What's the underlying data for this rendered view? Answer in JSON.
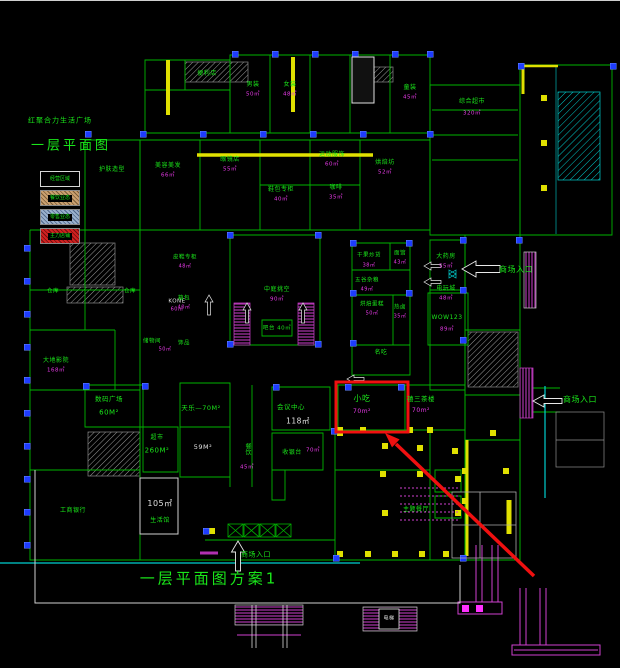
{
  "header": {
    "project_title": "红聚合力生活广场",
    "drawing_title": "一层平面图"
  },
  "footer": {
    "scheme_title": "一层平面图方案1"
  },
  "legend": {
    "items": [
      {
        "label": "经营区域",
        "swatch": "dark"
      },
      {
        "label": "餐饮业态",
        "swatch": "tan-hatch"
      },
      {
        "label": "零售业态",
        "swatch": "blue-hatch"
      },
      {
        "label": "主力店铺",
        "swatch": "red-hatch"
      }
    ]
  },
  "highlight": {
    "shop_name": "小吃",
    "shop_area": "70m²",
    "marker": "red-rectangle-with-arrow"
  },
  "colors": {
    "background": "#000000",
    "wall_green": "#00b400",
    "grid_cyan": "#00d0d0",
    "accent_yellow": "#e0e000",
    "detail_magenta": "#d040d0",
    "column_blue": "#1e3cff",
    "highlight_red": "#f01010",
    "text_green": "#1ae61a",
    "area_magenta": "#e83ae8",
    "text_white": "#e0e0e0"
  },
  "labels": [
    {
      "n": "entrance-label",
      "t": "商场入口",
      "x": 516,
      "y": 270,
      "s": 8,
      "c": "g"
    },
    {
      "n": "entrance-label",
      "t": "商场入口",
      "x": 580,
      "y": 400,
      "s": 8,
      "c": "g"
    },
    {
      "n": "entrance-label",
      "t": "商场入口",
      "x": 256,
      "y": 555,
      "s": 7,
      "c": "g"
    },
    {
      "n": "highlight-shop-name",
      "t": "小吃",
      "x": 362,
      "y": 399,
      "s": 8,
      "c": "g"
    },
    {
      "n": "highlight-shop-area",
      "t": "70m²",
      "x": 362,
      "y": 412,
      "s": 6,
      "c": "m"
    },
    {
      "n": "room-name",
      "t": "禧三茶楼",
      "x": 421,
      "y": 399,
      "s": 6.5,
      "c": "g"
    },
    {
      "n": "room-area",
      "t": "70m²",
      "x": 421,
      "y": 411,
      "s": 6,
      "c": "m"
    },
    {
      "n": "room-name",
      "t": "天乐—70M²",
      "x": 201,
      "y": 408,
      "s": 6.5,
      "c": "g"
    },
    {
      "n": "room-area",
      "t": "59M²",
      "x": 203,
      "y": 447,
      "s": 6.5,
      "c": "w"
    },
    {
      "n": "room-name",
      "t": "餐饮",
      "x": 247,
      "y": 449,
      "s": 6,
      "c": "g",
      "v": 1
    },
    {
      "n": "room-area",
      "t": "45㎡",
      "x": 247,
      "y": 468,
      "s": 5.5,
      "c": "m"
    },
    {
      "n": "room-name",
      "t": "会议中心",
      "x": 291,
      "y": 407,
      "s": 6.5,
      "c": "g"
    },
    {
      "n": "room-area",
      "t": "118㎡",
      "x": 298,
      "y": 421,
      "s": 7.5,
      "c": "w"
    },
    {
      "n": "room-name",
      "t": "收银台",
      "x": 292,
      "y": 453,
      "s": 6,
      "c": "g"
    },
    {
      "n": "room-area",
      "t": "70㎡",
      "x": 313,
      "y": 451,
      "s": 5.5,
      "c": "m"
    },
    {
      "n": "room-name",
      "t": "数码广场",
      "x": 109,
      "y": 399,
      "s": 6.5,
      "c": "g"
    },
    {
      "n": "room-area",
      "t": "60M²",
      "x": 109,
      "y": 413,
      "s": 7,
      "c": "g"
    },
    {
      "n": "room-name",
      "t": "超市",
      "x": 157,
      "y": 438,
      "s": 6,
      "c": "g"
    },
    {
      "n": "room-area",
      "t": "260M²",
      "x": 157,
      "y": 451,
      "s": 7,
      "c": "g"
    },
    {
      "n": "room-area",
      "t": "105㎡",
      "x": 160,
      "y": 504,
      "s": 8,
      "c": "w"
    },
    {
      "n": "room-name",
      "t": "生活馆",
      "x": 160,
      "y": 521,
      "s": 6,
      "c": "g"
    },
    {
      "n": "room-name",
      "t": "工商银行",
      "x": 73,
      "y": 511,
      "s": 6,
      "c": "g"
    },
    {
      "n": "elevator-label",
      "t": "KONE",
      "x": 177,
      "y": 302,
      "s": 5.5,
      "c": "w"
    },
    {
      "n": "room-area",
      "t": "60㎡",
      "x": 177,
      "y": 310,
      "s": 5,
      "c": "m"
    },
    {
      "n": "room-name",
      "t": "大地影院",
      "x": 56,
      "y": 361,
      "s": 6,
      "c": "g"
    },
    {
      "n": "room-area",
      "t": "168㎡",
      "x": 56,
      "y": 371,
      "s": 5.5,
      "c": "m"
    },
    {
      "n": "room-name",
      "t": "仓库",
      "x": 53,
      "y": 292,
      "s": 5.5,
      "c": "g"
    },
    {
      "n": "room-name",
      "t": "仓库",
      "x": 130,
      "y": 292,
      "s": 5.5,
      "c": "g"
    },
    {
      "n": "room-name",
      "t": "储物间",
      "x": 152,
      "y": 342,
      "s": 5.5,
      "c": "g"
    },
    {
      "n": "room-area",
      "t": "50㎡",
      "x": 165,
      "y": 350,
      "s": 5,
      "c": "m"
    },
    {
      "n": "room-name",
      "t": "男装",
      "x": 253,
      "y": 85,
      "s": 6,
      "c": "g"
    },
    {
      "n": "room-area",
      "t": "50㎡",
      "x": 253,
      "y": 95,
      "s": 5.5,
      "c": "m"
    },
    {
      "n": "room-name",
      "t": "女装",
      "x": 290,
      "y": 85,
      "s": 6,
      "c": "g"
    },
    {
      "n": "room-area",
      "t": "48㎡",
      "x": 290,
      "y": 95,
      "s": 5.5,
      "c": "m"
    },
    {
      "n": "room-name",
      "t": "童装",
      "x": 410,
      "y": 88,
      "s": 6,
      "c": "g"
    },
    {
      "n": "room-area",
      "t": "45㎡",
      "x": 410,
      "y": 98,
      "s": 5.5,
      "c": "m"
    },
    {
      "n": "room-name",
      "t": "便利店",
      "x": 207,
      "y": 74,
      "s": 6,
      "c": "g"
    },
    {
      "n": "room-name",
      "t": "综合超市",
      "x": 472,
      "y": 102,
      "s": 6,
      "c": "g"
    },
    {
      "n": "room-area",
      "t": "320㎡",
      "x": 472,
      "y": 114,
      "s": 5.5,
      "c": "m"
    },
    {
      "n": "room-name",
      "t": "护肤造型",
      "x": 112,
      "y": 170,
      "s": 6,
      "c": "g"
    },
    {
      "n": "room-name",
      "t": "美容美发",
      "x": 168,
      "y": 166,
      "s": 6,
      "c": "g"
    },
    {
      "n": "room-area",
      "t": "66㎡",
      "x": 168,
      "y": 176,
      "s": 5.5,
      "c": "m"
    },
    {
      "n": "room-name",
      "t": "眼镜店",
      "x": 230,
      "y": 160,
      "s": 6,
      "c": "g"
    },
    {
      "n": "room-area",
      "t": "55㎡",
      "x": 230,
      "y": 170,
      "s": 5.5,
      "c": "m"
    },
    {
      "n": "room-name",
      "t": "鞋包专柜",
      "x": 281,
      "y": 190,
      "s": 6,
      "c": "g"
    },
    {
      "n": "room-area",
      "t": "40㎡",
      "x": 281,
      "y": 200,
      "s": 5.5,
      "c": "m"
    },
    {
      "n": "room-name",
      "t": "运动服饰",
      "x": 332,
      "y": 155,
      "s": 6,
      "c": "g"
    },
    {
      "n": "room-area",
      "t": "60㎡",
      "x": 332,
      "y": 165,
      "s": 5.5,
      "c": "m"
    },
    {
      "n": "room-name",
      "t": "咖啡",
      "x": 336,
      "y": 188,
      "s": 6,
      "c": "g"
    },
    {
      "n": "room-area",
      "t": "35㎡",
      "x": 336,
      "y": 198,
      "s": 5.5,
      "c": "m"
    },
    {
      "n": "room-name",
      "t": "烘焙坊",
      "x": 385,
      "y": 163,
      "s": 6,
      "c": "g"
    },
    {
      "n": "room-area",
      "t": "52㎡",
      "x": 385,
      "y": 173,
      "s": 5.5,
      "c": "m"
    },
    {
      "n": "room-name",
      "t": "皮鞋专柜",
      "x": 185,
      "y": 258,
      "s": 5.5,
      "c": "g"
    },
    {
      "n": "room-area",
      "t": "48㎡",
      "x": 185,
      "y": 267,
      "s": 5,
      "c": "m"
    },
    {
      "n": "room-name",
      "t": "箱包",
      "x": 184,
      "y": 299,
      "s": 5.5,
      "c": "g"
    },
    {
      "n": "room-area",
      "t": "40㎡",
      "x": 184,
      "y": 308,
      "s": 5,
      "c": "m"
    },
    {
      "n": "room-name",
      "t": "饰品",
      "x": 184,
      "y": 344,
      "s": 5.5,
      "c": "g"
    },
    {
      "n": "room-name",
      "t": "大药房",
      "x": 446,
      "y": 257,
      "s": 6,
      "c": "g"
    },
    {
      "n": "room-area",
      "t": "55㎡",
      "x": 446,
      "y": 267,
      "s": 5.5,
      "c": "m"
    },
    {
      "n": "room-name",
      "t": "电玩城",
      "x": 446,
      "y": 289,
      "s": 6,
      "c": "g"
    },
    {
      "n": "room-area",
      "t": "48㎡",
      "x": 446,
      "y": 299,
      "s": 5.5,
      "c": "m"
    },
    {
      "n": "atrium-label",
      "t": "中庭挑空",
      "x": 277,
      "y": 290,
      "s": 6,
      "c": "g"
    },
    {
      "n": "room-area",
      "t": "90㎡",
      "x": 277,
      "y": 300,
      "s": 5.5,
      "c": "m"
    },
    {
      "n": "room-name",
      "t": "吧台 40㎡",
      "x": 277,
      "y": 329,
      "s": 5.5,
      "c": "g"
    },
    {
      "n": "room-name",
      "t": "干果炒货",
      "x": 369,
      "y": 256,
      "s": 5.5,
      "c": "g"
    },
    {
      "n": "room-area",
      "t": "38㎡",
      "x": 369,
      "y": 266,
      "s": 5,
      "c": "m"
    },
    {
      "n": "room-name",
      "t": "面馆",
      "x": 400,
      "y": 254,
      "s": 5.5,
      "c": "g"
    },
    {
      "n": "room-area",
      "t": "43㎡",
      "x": 400,
      "y": 263,
      "s": 5,
      "c": "m"
    },
    {
      "n": "room-name",
      "t": "五谷杂粮",
      "x": 367,
      "y": 281,
      "s": 5.5,
      "c": "g"
    },
    {
      "n": "room-area",
      "t": "49㎡",
      "x": 367,
      "y": 290,
      "s": 5,
      "c": "m"
    },
    {
      "n": "room-name",
      "t": "烘焙蛋糕",
      "x": 372,
      "y": 305,
      "s": 5.5,
      "c": "g"
    },
    {
      "n": "room-area",
      "t": "50㎡",
      "x": 372,
      "y": 314,
      "s": 5,
      "c": "m"
    },
    {
      "n": "room-name",
      "t": "热卤",
      "x": 400,
      "y": 308,
      "s": 5.5,
      "c": "g"
    },
    {
      "n": "room-area",
      "t": "35㎡",
      "x": 400,
      "y": 317,
      "s": 5,
      "c": "m"
    },
    {
      "n": "room-name",
      "t": "名吃",
      "x": 381,
      "y": 353,
      "s": 6,
      "c": "g"
    },
    {
      "n": "room-name",
      "t": "WOW123",
      "x": 447,
      "y": 318,
      "s": 6,
      "c": "g"
    },
    {
      "n": "room-area",
      "t": "89㎡",
      "x": 447,
      "y": 330,
      "s": 5.5,
      "c": "m"
    },
    {
      "n": "room-name",
      "t": "主题餐厅",
      "x": 416,
      "y": 510,
      "s": 6,
      "c": "g"
    },
    {
      "n": "elevator-label",
      "t": "电梯",
      "x": 389,
      "y": 619,
      "s": 5,
      "c": "w"
    }
  ]
}
